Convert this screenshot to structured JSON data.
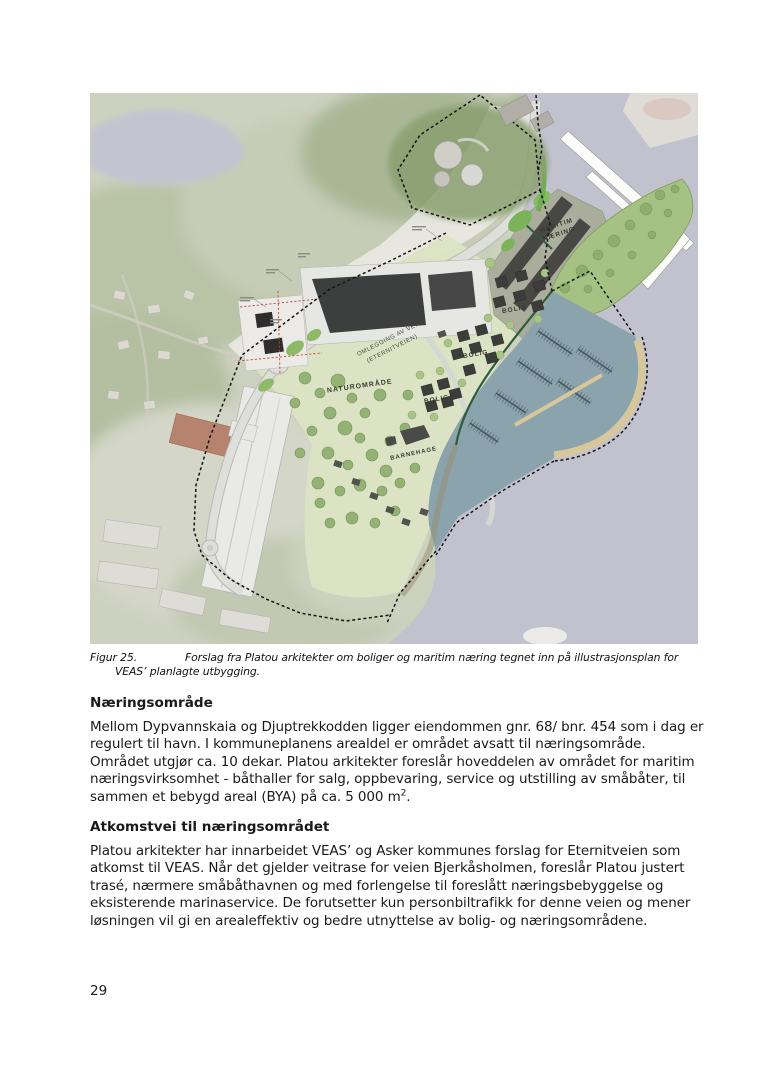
{
  "page": {
    "number": "29"
  },
  "figure": {
    "caption_label": "Figur 25.",
    "caption_text": "Forslag fra Platou arkitekter om boliger og maritim næring tegnet inn på illustrasjonsplan for VEAS’ planlagte utbygging."
  },
  "map": {
    "labels": {
      "maritim_line1": "MARITIM",
      "maritim_line2": "NÆRING",
      "bolig": "BOLIG",
      "naturomrade": "NATUROMRÅDE",
      "barnehage": "BARNEHAGE",
      "road_line1": "OMLEGGING AV VEI",
      "road_line2": "(ETERNITVEIEN)"
    },
    "colors": {
      "sea": "#c1c2ce",
      "harbor_basin": "#8ba3ad",
      "breakwater": "#d9c79c",
      "aerial_land": "#cdd1c0",
      "plan_lawn": "#dce4c4",
      "tree_green": "#94b274",
      "building_dark": "#3d3e3e",
      "road": "#dededb"
    }
  },
  "sections": [
    {
      "heading": "Næringsområde",
      "body": "Mellom Dypvannskaia og Djuptrekkodden ligger eiendommen gnr. 68/ bnr. 454 som i dag er regulert til havn. I kommuneplanens arealdel er området avsatt til næringsområde. Området utgjør ca. 10 dekar. Platou arkitekter foreslår hoveddelen av området for maritim næringsvirksomhet - båthaller for salg, oppbevaring, service og utstilling av småbåter, til sammen et bebygd areal (BYA) på ca. 5 000 m",
      "sup": "2",
      "after_sup": "."
    },
    {
      "heading": "Atkomstvei til næringsområdet",
      "body": "Platou arkitekter har innarbeidet VEAS’ og Asker kommunes forslag for Eternitveien som atkomst til VEAS.  Når det gjelder veitrase for veien Bjerkåsholmen, foreslår Platou justert trasé, nærmere småbåthavnen og med forlengelse til foreslått næringsbebyggelse og eksisterende marinaservice. De forutsetter kun personbiltrafikk for denne veien og mener løsningen vil gi en arealeffektiv og bedre utnyttelse av bolig- og næringsområdene."
    }
  ]
}
